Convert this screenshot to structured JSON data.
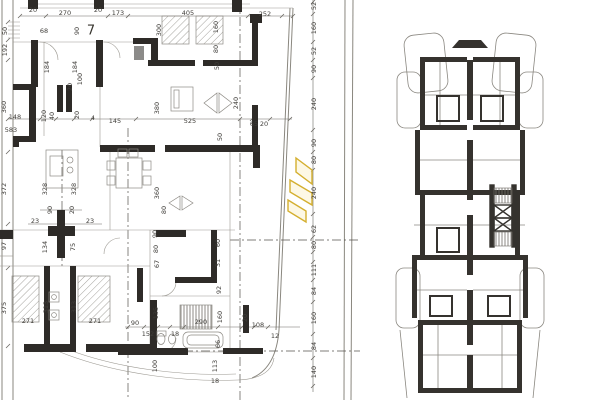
{
  "sheet": {
    "description": "scanned architectural floor plan drawing",
    "left_plan_name": "detailed apartment floor plan",
    "right_plan_name": "overview building floor plan",
    "room_number": "7"
  },
  "colors": {
    "background": "#ffffff",
    "wall": "#2e2b28",
    "thin_line": "#928f89",
    "dim_line": "#6b6862",
    "dim_text": "#403e3a",
    "highlight_stroke": "#d4af2f",
    "highlight_fill": "#fbf3cf"
  },
  "labels": [
    {
      "t": "7",
      "x": 91,
      "y": 31,
      "v": false,
      "big": true
    },
    {
      "t": "270",
      "x": 65,
      "y": 13,
      "v": false
    },
    {
      "t": "173",
      "x": 118,
      "y": 13,
      "v": false
    },
    {
      "t": "405",
      "x": 188,
      "y": 13,
      "v": false
    },
    {
      "t": "252",
      "x": 265,
      "y": 14,
      "v": false
    },
    {
      "t": "20",
      "x": 33,
      "y": 10,
      "v": false
    },
    {
      "t": "20",
      "x": 98,
      "y": 10,
      "v": false
    },
    {
      "t": "50",
      "x": 5,
      "y": 31,
      "v": true
    },
    {
      "t": "192",
      "x": 5,
      "y": 50,
      "v": true
    },
    {
      "t": "360",
      "x": 4,
      "y": 107,
      "v": true
    },
    {
      "t": "372",
      "x": 4,
      "y": 189,
      "v": true
    },
    {
      "t": "97",
      "x": 4,
      "y": 246,
      "v": true
    },
    {
      "t": "375",
      "x": 4,
      "y": 308,
      "v": true
    },
    {
      "t": "68",
      "x": 44,
      "y": 31,
      "v": false
    },
    {
      "t": "90",
      "x": 77,
      "y": 31,
      "v": true
    },
    {
      "t": "184",
      "x": 47,
      "y": 67,
      "v": true
    },
    {
      "t": "184",
      "x": 75,
      "y": 67,
      "v": true
    },
    {
      "t": "100",
      "x": 80,
      "y": 79,
      "v": true
    },
    {
      "t": "20",
      "x": 70,
      "y": 87,
      "v": true
    },
    {
      "t": "583",
      "x": 11,
      "y": 130,
      "v": false
    },
    {
      "t": "300",
      "x": 159,
      "y": 30,
      "v": true
    },
    {
      "t": "160",
      "x": 216,
      "y": 27,
      "v": true
    },
    {
      "t": "80",
      "x": 216,
      "y": 49,
      "v": true
    },
    {
      "t": "50",
      "x": 217,
      "y": 66,
      "v": true
    },
    {
      "t": "380",
      "x": 157,
      "y": 108,
      "v": true
    },
    {
      "t": "240",
      "x": 236,
      "y": 103,
      "v": true
    },
    {
      "t": "525",
      "x": 190,
      "y": 121,
      "v": false
    },
    {
      "t": "145",
      "x": 115,
      "y": 121,
      "v": false
    },
    {
      "t": "65",
      "x": 254,
      "y": 124,
      "v": false
    },
    {
      "t": "20",
      "x": 264,
      "y": 124,
      "v": false
    },
    {
      "t": "148",
      "x": 15,
      "y": 117,
      "v": false
    },
    {
      "t": "120",
      "x": 44,
      "y": 116,
      "v": true
    },
    {
      "t": "40",
      "x": 52,
      "y": 116,
      "v": true
    },
    {
      "t": "20",
      "x": 77,
      "y": 115,
      "v": true
    },
    {
      "t": "4",
      "x": 93,
      "y": 118,
      "v": false
    },
    {
      "t": "360",
      "x": 157,
      "y": 193,
      "v": true
    },
    {
      "t": "80",
      "x": 164,
      "y": 210,
      "v": true
    },
    {
      "t": "328",
      "x": 45,
      "y": 189,
      "v": true
    },
    {
      "t": "328",
      "x": 74,
      "y": 189,
      "v": true
    },
    {
      "t": "90",
      "x": 50,
      "y": 210,
      "v": true
    },
    {
      "t": "20",
      "x": 72,
      "y": 210,
      "v": true
    },
    {
      "t": "23",
      "x": 35,
      "y": 221,
      "v": false
    },
    {
      "t": "23",
      "x": 90,
      "y": 221,
      "v": false
    },
    {
      "t": "134",
      "x": 45,
      "y": 247,
      "v": true
    },
    {
      "t": "75",
      "x": 73,
      "y": 247,
      "v": true
    },
    {
      "t": "50",
      "x": 220,
      "y": 137,
      "v": true
    },
    {
      "t": "90",
      "x": 155,
      "y": 234,
      "v": true
    },
    {
      "t": "80",
      "x": 156,
      "y": 249,
      "v": true
    },
    {
      "t": "67",
      "x": 157,
      "y": 264,
      "v": true
    },
    {
      "t": "60",
      "x": 218,
      "y": 243,
      "v": true
    },
    {
      "t": "31",
      "x": 218,
      "y": 263,
      "v": true
    },
    {
      "t": "92",
      "x": 219,
      "y": 290,
      "v": true
    },
    {
      "t": "313",
      "x": 46,
      "y": 307,
      "v": true
    },
    {
      "t": "313",
      "x": 74,
      "y": 307,
      "v": true
    },
    {
      "t": "271",
      "x": 28,
      "y": 321,
      "v": false
    },
    {
      "t": "271",
      "x": 95,
      "y": 321,
      "v": false
    },
    {
      "t": "90",
      "x": 135,
      "y": 323,
      "v": false
    },
    {
      "t": "152",
      "x": 148,
      "y": 334,
      "v": false
    },
    {
      "t": "135",
      "x": 156,
      "y": 313,
      "v": true
    },
    {
      "t": "18",
      "x": 175,
      "y": 334,
      "v": false
    },
    {
      "t": "290",
      "x": 201,
      "y": 322,
      "v": false
    },
    {
      "t": "160",
      "x": 220,
      "y": 317,
      "v": true
    },
    {
      "t": "20",
      "x": 245,
      "y": 318,
      "v": true
    },
    {
      "t": "108",
      "x": 258,
      "y": 325,
      "v": false
    },
    {
      "t": "12",
      "x": 275,
      "y": 336,
      "v": false
    },
    {
      "t": "66",
      "x": 218,
      "y": 344,
      "v": true
    },
    {
      "t": "100",
      "x": 155,
      "y": 366,
      "v": true
    },
    {
      "t": "113",
      "x": 215,
      "y": 366,
      "v": true
    },
    {
      "t": "18",
      "x": 215,
      "y": 381,
      "v": false
    },
    {
      "t": "52",
      "x": 314,
      "y": 6,
      "v": true
    },
    {
      "t": "160",
      "x": 314,
      "y": 28,
      "v": true
    },
    {
      "t": "52",
      "x": 314,
      "y": 51,
      "v": true
    },
    {
      "t": "90",
      "x": 314,
      "y": 69,
      "v": true
    },
    {
      "t": "240",
      "x": 314,
      "y": 104,
      "v": true
    },
    {
      "t": "90",
      "x": 314,
      "y": 143,
      "v": true
    },
    {
      "t": "80",
      "x": 314,
      "y": 160,
      "v": true
    },
    {
      "t": "240",
      "x": 314,
      "y": 193,
      "v": true
    },
    {
      "t": "62",
      "x": 314,
      "y": 229,
      "v": true
    },
    {
      "t": "80",
      "x": 314,
      "y": 245,
      "v": true
    },
    {
      "t": "111",
      "x": 314,
      "y": 270,
      "v": true
    },
    {
      "t": "84",
      "x": 314,
      "y": 291,
      "v": true
    },
    {
      "t": "160",
      "x": 314,
      "y": 318,
      "v": true
    },
    {
      "t": "84",
      "x": 314,
      "y": 346,
      "v": true
    },
    {
      "t": "140",
      "x": 314,
      "y": 372,
      "v": true
    }
  ]
}
